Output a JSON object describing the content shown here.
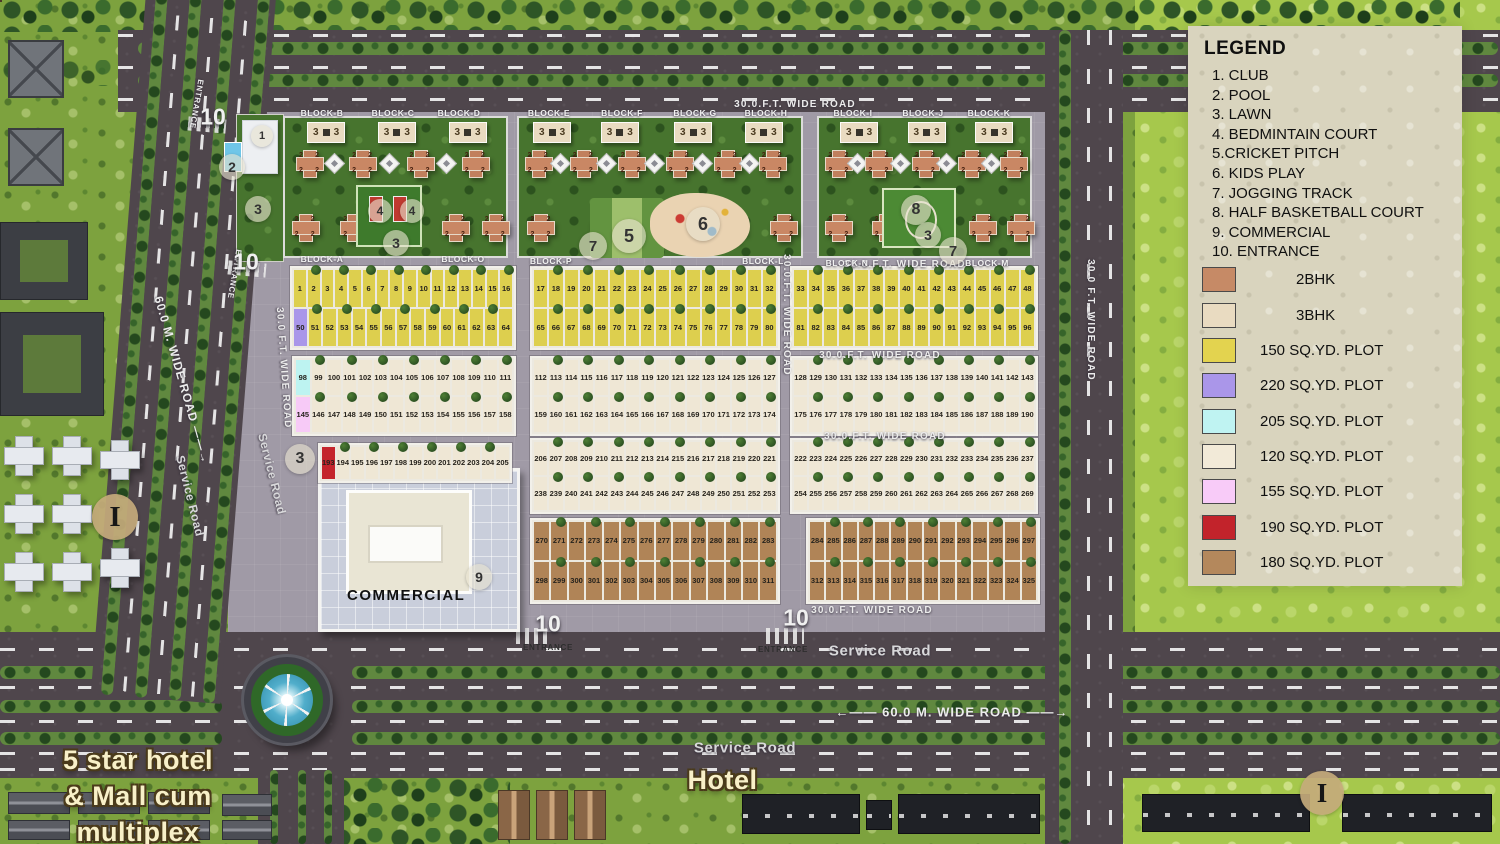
{
  "legend": {
    "title": "LEGEND",
    "items": [
      "1. CLUB",
      "2. POOL",
      "3. LAWN",
      "4. BEDMINTAIN COURT",
      "5.CRICKET PITCH",
      "6. KIDS PLAY",
      "7. JOGGING TRACK",
      "8. HALF BASKETBALL COURT",
      "9. COMMERCIAL",
      "10. ENTRANCE"
    ],
    "swatches": [
      {
        "color": "#c68a66",
        "label": "2BHK",
        "pad": true
      },
      {
        "color": "#e9dbc1",
        "label": "3BHK",
        "pad": true
      },
      {
        "color": "#e3d34f",
        "label": "150 SQ.YD. PLOT"
      },
      {
        "color": "#aa96e9",
        "label": "220 SQ.YD. PLOT"
      },
      {
        "color": "#bff3f2",
        "label": "205 SQ.YD. PLOT"
      },
      {
        "color": "#f2ead8",
        "label": "120 SQ.YD. PLOT"
      },
      {
        "color": "#f8cbf8",
        "label": "155 SQ.YD. PLOT"
      },
      {
        "color": "#c2232b",
        "label": "190 SQ.YD. PLOT"
      },
      {
        "color": "#b4885c",
        "label": "180 SQ.YD. PLOT"
      }
    ]
  },
  "labels": {
    "commercial": "COMMERCIAL",
    "hotel": "Hotel",
    "five_star_line1": "5 star hotel",
    "five_star_line2": "& Mall cum multiplex",
    "unit2": "2",
    "unit3": "3"
  },
  "road_labels": [
    {
      "t": "30.0.F.T. WIDE ROAD",
      "x": 795,
      "y": 105
    },
    {
      "t": "30.0.F.T. WIDE ROAD",
      "x": 905,
      "y": 265
    },
    {
      "t": "30.0.F.T. WIDE ROAD",
      "x": 880,
      "y": 356
    },
    {
      "t": "30.0.F.T. WIDE ROAD",
      "x": 885,
      "y": 437
    },
    {
      "t": "30.0.F.T. WIDE ROAD",
      "x": 872,
      "y": 611
    },
    {
      "t": "30.0 F.T. WIDE ROAD",
      "x": 283,
      "y": 368,
      "r": 86
    },
    {
      "t": "30.0.F.T. WIDE ROAD",
      "x": 786,
      "y": 315,
      "r": 90
    },
    {
      "t": "30.0 F.T. WIDE ROAD",
      "x": 1090,
      "y": 320,
      "r": 90
    },
    {
      "t": "←——  60.0 M. WIDE ROAD  ——→",
      "x": 952,
      "y": 712,
      "c": "m60"
    },
    {
      "t": "60.0 M. WIDE ROAD ——→",
      "x": 182,
      "y": 380,
      "r": 74,
      "c": "m60d"
    },
    {
      "t": "Service Road",
      "x": 880,
      "y": 651,
      "c": "srv"
    },
    {
      "t": "Service Road",
      "x": 745,
      "y": 748,
      "c": "srv"
    },
    {
      "t": "Service Road",
      "x": 190,
      "y": 496,
      "r": 76,
      "c": "srv srv-sm"
    },
    {
      "t": "Service Road",
      "x": 272,
      "y": 474,
      "r": 76,
      "c": "srv srv-sm"
    },
    {
      "t": "ENTRANCE",
      "x": 548,
      "y": 648,
      "c": "ent"
    },
    {
      "t": "ENTRANCE",
      "x": 783,
      "y": 650,
      "c": "ent"
    },
    {
      "t": "ENTRANCE",
      "x": 196,
      "y": 104,
      "r": 100,
      "c": "ent-l"
    },
    {
      "t": "ENTRANCE",
      "x": 234,
      "y": 274,
      "r": 100,
      "c": "ent-l"
    },
    {
      "t": "10",
      "x": 213,
      "y": 117,
      "c": "ten"
    },
    {
      "t": "10",
      "x": 246,
      "y": 262,
      "c": "ten"
    },
    {
      "t": "10",
      "x": 548,
      "y": 624,
      "c": "ten"
    },
    {
      "t": "10",
      "x": 796,
      "y": 618,
      "c": "ten"
    },
    {
      "t": "BLOCK-B",
      "x": 322,
      "y": 113,
      "c": "blk"
    },
    {
      "t": "BLOCK-C",
      "x": 393,
      "y": 113,
      "c": "blk"
    },
    {
      "t": "BLOCK-D",
      "x": 459,
      "y": 113,
      "c": "blk"
    },
    {
      "t": "BLOCK-A",
      "x": 322,
      "y": 259,
      "c": "blk"
    },
    {
      "t": "BLOCK-O",
      "x": 463,
      "y": 259,
      "c": "blk"
    },
    {
      "t": "BLOCK-E",
      "x": 549,
      "y": 113,
      "c": "blk"
    },
    {
      "t": "BLOCK-F",
      "x": 622,
      "y": 113,
      "c": "blk"
    },
    {
      "t": "BLOCK-G",
      "x": 695,
      "y": 113,
      "c": "blk"
    },
    {
      "t": "BLOCK-H",
      "x": 766,
      "y": 113,
      "c": "blk"
    },
    {
      "t": "BLOCK-P",
      "x": 551,
      "y": 261,
      "c": "blk"
    },
    {
      "t": "BLOCK-L",
      "x": 763,
      "y": 261,
      "c": "blk"
    },
    {
      "t": "BLOCK-I",
      "x": 853,
      "y": 113,
      "c": "blk"
    },
    {
      "t": "BLOCK-J",
      "x": 923,
      "y": 113,
      "c": "blk"
    },
    {
      "t": "BLOCK-K",
      "x": 989,
      "y": 113,
      "c": "blk"
    },
    {
      "t": "BLOCK-N",
      "x": 847,
      "y": 263,
      "c": "blk"
    },
    {
      "t": "BLOCK-M",
      "x": 987,
      "y": 263,
      "c": "blk"
    }
  ],
  "markers": [
    {
      "n": "1",
      "x": 262,
      "y": 136,
      "d": 22
    },
    {
      "n": "2",
      "x": 232,
      "y": 167,
      "d": 26
    },
    {
      "n": "3",
      "x": 258,
      "y": 209,
      "d": 26
    },
    {
      "n": "4",
      "x": 380,
      "y": 211,
      "d": 24
    },
    {
      "n": "4",
      "x": 412,
      "y": 211,
      "d": 24
    },
    {
      "n": "3",
      "x": 396,
      "y": 243,
      "d": 26
    },
    {
      "n": "7",
      "x": 593,
      "y": 246,
      "d": 28
    },
    {
      "n": "5",
      "x": 629,
      "y": 236,
      "d": 34
    },
    {
      "n": "6",
      "x": 703,
      "y": 224,
      "d": 34
    },
    {
      "n": "8",
      "x": 916,
      "y": 210,
      "d": 30
    },
    {
      "n": "3",
      "x": 928,
      "y": 235,
      "d": 26
    },
    {
      "n": "7",
      "x": 953,
      "y": 251,
      "d": 28
    },
    {
      "n": "3",
      "x": 300,
      "y": 459,
      "d": 30
    },
    {
      "n": "9",
      "x": 479,
      "y": 577,
      "d": 26
    },
    {
      "n": "I",
      "x": 115,
      "y": 517,
      "d": 46,
      "c": "serif"
    },
    {
      "n": "I",
      "x": 1322,
      "y": 793,
      "d": 44,
      "c": "serif"
    }
  ],
  "clusters": [
    {
      "x": 283,
      "y": 116,
      "w": 225,
      "h": 142,
      "beige": 3,
      "ct": 4,
      "cb": 4
    },
    {
      "x": 517,
      "y": 116,
      "w": 286,
      "h": 142,
      "beige": 4,
      "ct": 6,
      "cb": 4
    },
    {
      "x": 817,
      "y": 116,
      "w": 215,
      "h": 142,
      "beige": 3,
      "ct": 5,
      "cb": 4
    }
  ],
  "amenities": [
    {
      "type": "club",
      "x": 242,
      "y": 120,
      "w": 36,
      "h": 54
    },
    {
      "type": "pool",
      "x": 224,
      "y": 142,
      "w": 18,
      "h": 30
    },
    {
      "type": "badminton",
      "x": 356,
      "y": 185,
      "w": 66,
      "h": 62
    },
    {
      "type": "cricket",
      "x": 590,
      "y": 198,
      "w": 74,
      "h": 60
    },
    {
      "type": "kidsplay",
      "x": 650,
      "y": 193,
      "w": 100,
      "h": 64
    },
    {
      "type": "basketball",
      "x": 882,
      "y": 188,
      "w": 74,
      "h": 60
    }
  ],
  "plot_blocks": [
    {
      "x": 290,
      "y": 266,
      "w": 226,
      "h": 84,
      "base": "#ddcf4e",
      "specials": {
        "50": "#a996e9"
      },
      "rows": [
        [
          1,
          2,
          3,
          4,
          5,
          6,
          7,
          8,
          9,
          10,
          11,
          12,
          13,
          14,
          15,
          16
        ],
        [
          50,
          51,
          52,
          53,
          54,
          55,
          56,
          57,
          58,
          59,
          60,
          61,
          62,
          63,
          64
        ]
      ]
    },
    {
      "x": 530,
      "y": 266,
      "w": 250,
      "h": 84,
      "base": "#ddcf4e",
      "rows": [
        [
          17,
          18,
          19,
          20,
          21,
          22,
          23,
          24,
          25,
          26,
          27,
          28,
          29,
          30,
          31,
          32
        ],
        [
          65,
          66,
          67,
          68,
          69,
          70,
          71,
          72,
          73,
          74,
          75,
          76,
          77,
          78,
          79,
          80
        ]
      ]
    },
    {
      "x": 790,
      "y": 266,
      "w": 248,
      "h": 84,
      "base": "#ddcf4e",
      "rows": [
        [
          33,
          34,
          35,
          36,
          37,
          38,
          39,
          40,
          41,
          42,
          43,
          44,
          45,
          46,
          47,
          48
        ],
        [
          81,
          82,
          83,
          84,
          85,
          86,
          87,
          88,
          89,
          90,
          91,
          92,
          93,
          94,
          95,
          96
        ]
      ]
    },
    {
      "x": 292,
      "y": 356,
      "w": 224,
      "h": 80,
      "base": "#efe7d5",
      "specials": {
        "98": "#bdf3f1",
        "145": "#f7caf7"
      },
      "rows": [
        [
          98,
          99,
          100,
          101,
          102,
          103,
          104,
          105,
          106,
          107,
          108,
          109,
          110,
          111
        ],
        [
          145,
          146,
          147,
          148,
          149,
          150,
          151,
          152,
          153,
          154,
          155,
          156,
          157,
          158
        ]
      ]
    },
    {
      "x": 530,
      "y": 356,
      "w": 250,
      "h": 80,
      "base": "#efe7d5",
      "rows": [
        [
          112,
          113,
          114,
          115,
          116,
          117,
          118,
          119,
          120,
          121,
          122,
          123,
          124,
          125,
          126,
          127
        ],
        [
          159,
          160,
          161,
          162,
          163,
          164,
          165,
          166,
          167,
          168,
          169,
          170,
          171,
          172,
          173,
          174
        ]
      ]
    },
    {
      "x": 790,
      "y": 356,
      "w": 248,
      "h": 80,
      "base": "#efe7d5",
      "rows": [
        [
          128,
          129,
          130,
          131,
          132,
          133,
          134,
          135,
          136,
          137,
          138,
          139,
          140,
          141,
          142,
          143
        ],
        [
          175,
          176,
          177,
          178,
          179,
          180,
          181,
          182,
          183,
          184,
          185,
          186,
          187,
          188,
          189,
          190
        ]
      ]
    },
    {
      "x": 318,
      "y": 443,
      "w": 194,
      "h": 40,
      "base": "#efe7d5",
      "specials": {
        "193": "#c4242c"
      },
      "rows": [
        [
          193,
          194,
          195,
          196,
          197,
          198,
          199,
          200,
          201,
          202,
          203,
          204,
          205
        ]
      ]
    },
    {
      "x": 530,
      "y": 438,
      "w": 250,
      "h": 76,
      "base": "#efe7d5",
      "rows": [
        [
          206,
          207,
          208,
          209,
          210,
          211,
          212,
          213,
          214,
          215,
          216,
          217,
          218,
          219,
          220,
          221
        ],
        [
          238,
          239,
          240,
          241,
          242,
          243,
          244,
          245,
          246,
          247,
          248,
          249,
          250,
          251,
          252,
          253
        ]
      ]
    },
    {
      "x": 790,
      "y": 438,
      "w": 248,
      "h": 76,
      "base": "#efe7d5",
      "rows": [
        [
          222,
          223,
          224,
          225,
          226,
          227,
          228,
          229,
          230,
          231,
          232,
          233,
          234,
          235,
          236,
          237
        ],
        [
          254,
          255,
          256,
          257,
          258,
          259,
          260,
          261,
          262,
          263,
          264,
          265,
          266,
          267,
          268,
          269
        ]
      ]
    },
    {
      "x": 530,
      "y": 518,
      "w": 250,
      "h": 86,
      "base": "#b08457",
      "rows": [
        [
          270,
          271,
          272,
          273,
          274,
          275,
          276,
          277,
          278,
          279,
          280,
          281,
          282,
          283
        ],
        [
          298,
          299,
          300,
          301,
          302,
          303,
          304,
          305,
          306,
          307,
          308,
          309,
          310,
          311
        ]
      ]
    },
    {
      "x": 806,
      "y": 518,
      "w": 234,
      "h": 86,
      "base": "#b08457",
      "rows": [
        [
          284,
          285,
          286,
          287,
          288,
          289,
          290,
          291,
          292,
          293,
          294,
          295,
          296,
          297
        ],
        [
          312,
          313,
          314,
          315,
          316,
          317,
          318,
          319,
          320,
          321,
          322,
          323,
          324,
          325
        ]
      ]
    }
  ]
}
